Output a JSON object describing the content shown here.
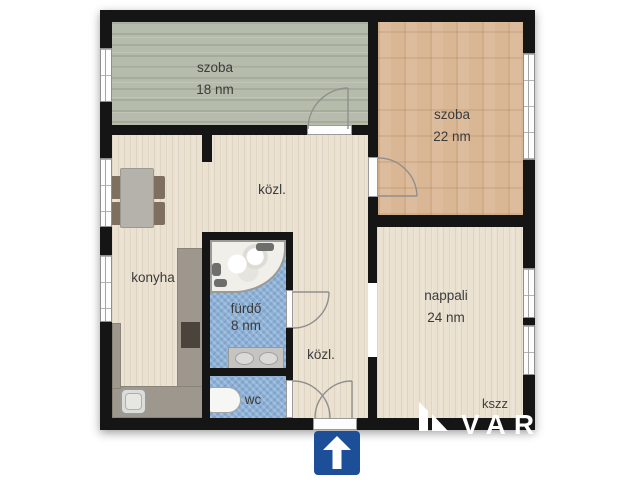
{
  "plan": {
    "rooms": [
      {
        "key": "szoba-18",
        "label": "szoba",
        "area": "18 nm"
      },
      {
        "key": "szoba-22",
        "label": "szoba",
        "area": "22 nm"
      },
      {
        "key": "kozl-upper",
        "label": "közl.",
        "area": ""
      },
      {
        "key": "konyha",
        "label": "konyha",
        "area": ""
      },
      {
        "key": "furdo",
        "label": "fürdő",
        "area": "8 nm"
      },
      {
        "key": "wc",
        "label": "wc",
        "area": ""
      },
      {
        "key": "kozl-lower",
        "label": "közl.",
        "area": ""
      },
      {
        "key": "nappali",
        "label": "nappali",
        "area": "24 nm"
      }
    ]
  },
  "watermark": {
    "code": "kszz",
    "brand": "VAR"
  },
  "colors": {
    "wall": "#151515",
    "floor_room_green": "#b6bcab",
    "floor_room_parquet": "#d9b795",
    "floor_hall_beige": "#eae1d1",
    "floor_bath_blue": "#8db1d6",
    "entrance_sign_blue": "#1d4f99",
    "label_text": "#3b3b3b"
  }
}
